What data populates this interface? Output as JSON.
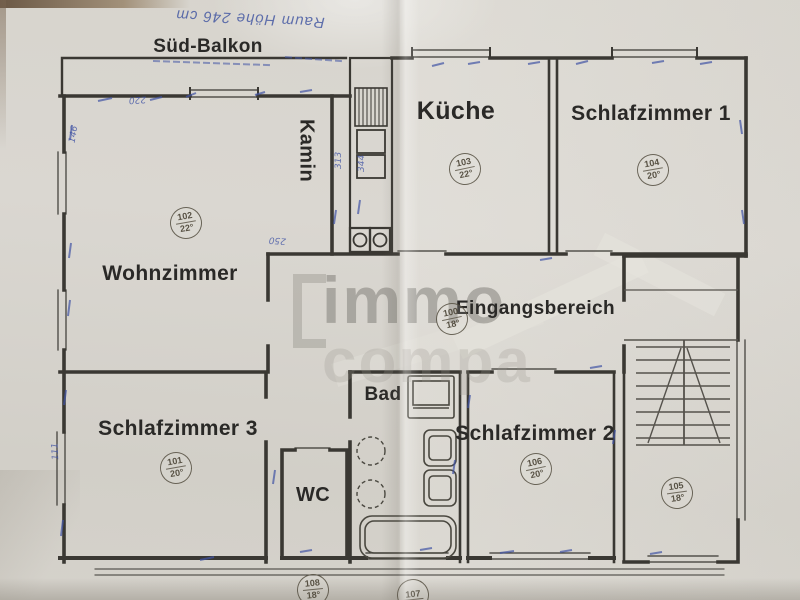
{
  "document": {
    "type": "floor-plan-scan"
  },
  "annotations": {
    "ceiling_note": "Raum Höhe 246 cm",
    "balcony": "Süd-Balkon",
    "measurements": {
      "m1": "220",
      "m2": "146",
      "m3": "313",
      "m4": "344",
      "m5": "250",
      "m6": "111"
    }
  },
  "watermark": {
    "line1": "immo",
    "line2": "compa"
  },
  "rooms": {
    "wohnzimmer": {
      "label": "Wohnzimmer",
      "number": "102",
      "temp": "22°"
    },
    "kamin": {
      "label": "Kamin"
    },
    "kueche": {
      "label": "Küche",
      "number": "103",
      "temp": "22°"
    },
    "schlafzimmer1": {
      "label": "Schlafzimmer 1",
      "number": "104",
      "temp": "20°"
    },
    "eingangsbereich": {
      "label": "Eingangsbereich",
      "number": "100",
      "temp": "18°"
    },
    "schlafzimmer3": {
      "label": "Schlafzimmer 3",
      "number": "101",
      "temp": "20°"
    },
    "schlafzimmer2": {
      "label": "Schlafzimmer 2",
      "number": "106",
      "temp": "20°"
    },
    "wc": {
      "label": "WC"
    },
    "bad": {
      "label": "Bad"
    },
    "treppenhaus": {
      "number": "105",
      "temp": "18°"
    },
    "stamp_108": {
      "number": "108",
      "temp": "18°"
    },
    "stamp_107": {
      "number": "107",
      "temp": ""
    }
  },
  "colors": {
    "ink": "#3a3833",
    "handwriting_blue": "#4154a5",
    "paper": "#d6d3cc",
    "stamp": "#554e40"
  }
}
